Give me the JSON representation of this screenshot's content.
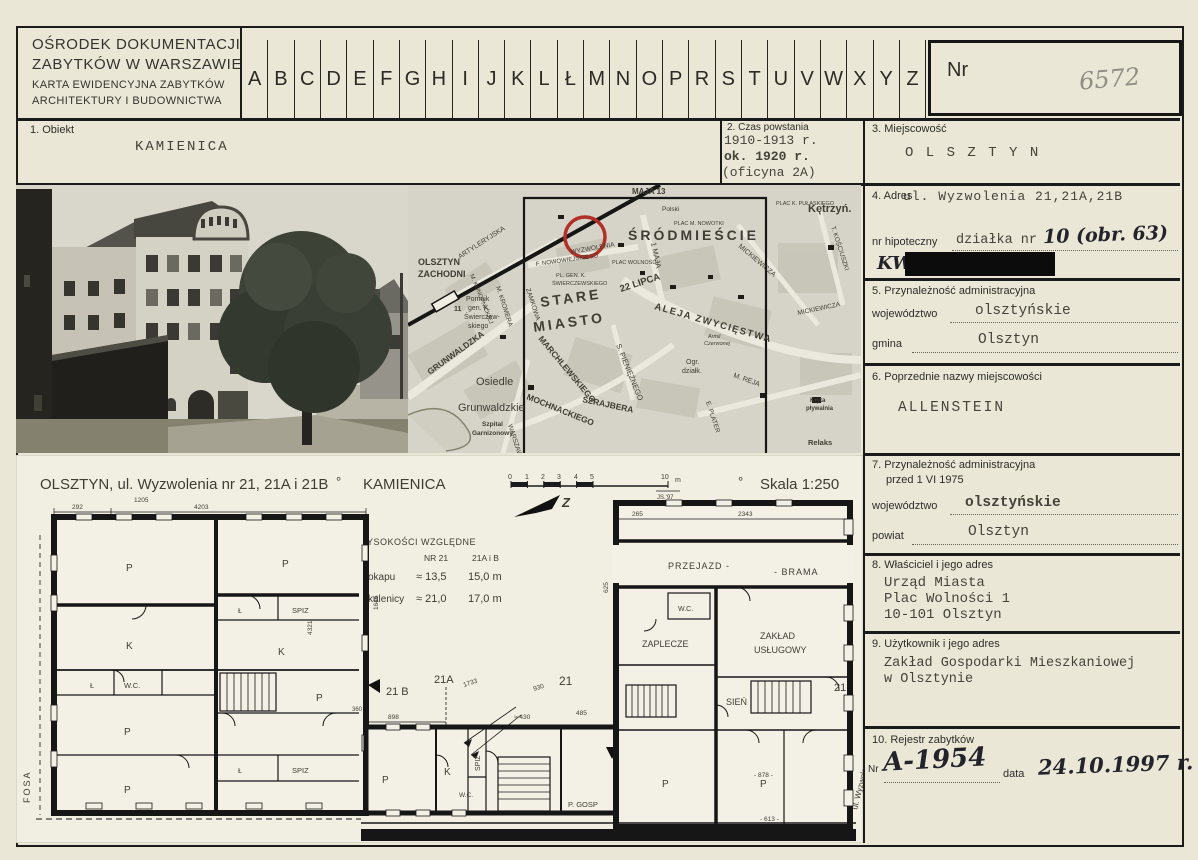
{
  "header": {
    "org_line1": "OŚRODEK DOKUMENTACJI",
    "org_line2": "ZABYTKÓW W WARSZAWIE",
    "card_line1": "KARTA EWIDENCYJNA ZABYTKÓW",
    "card_line2": "ARCHITEKTURY I BUDOWNICTWA",
    "alphabet": [
      "A",
      "B",
      "C",
      "D",
      "E",
      "F",
      "G",
      "H",
      "I",
      "J",
      "K",
      "L",
      "Ł",
      "M",
      "N",
      "O",
      "P",
      "R",
      "S",
      "T",
      "U",
      "V",
      "W",
      "X",
      "Y",
      "Z"
    ],
    "nr_label": "Nr",
    "nr_value": "6572"
  },
  "f1": {
    "label": "1. Obiekt",
    "value": "KAMIENICA"
  },
  "f2": {
    "label": "2. Czas powstania",
    "line1": "1910-1913 r.",
    "line2": "ok. 1920 r.",
    "line3": "(oficyna 2A)"
  },
  "f3": {
    "label": "3. Miejscowość",
    "value": "O L S Z T Y N"
  },
  "f4": {
    "label": "4. Adres",
    "address": "ul. Wyzwolenia 21,21A,21B",
    "hip_label": "nr hipoteczny",
    "hip_typed": "działka nr",
    "hip_hand": "10 (obr. 63)",
    "kw": "KW"
  },
  "f5": {
    "label": "5. Przynależność administracyjna",
    "woj_label": "województwo",
    "woj": "olsztyńskie",
    "gmina_label": "gmina",
    "gmina": "Olsztyn"
  },
  "f6": {
    "label": "6. Poprzednie nazwy miejscowości",
    "value": "ALLENSTEIN"
  },
  "f7": {
    "label": "7. Przynależność administracyjna",
    "label2": "przed 1 VI 1975",
    "woj_label": "województwo",
    "woj": "olsztyńskie",
    "powiat_label": "powiat",
    "powiat": "Olsztyn"
  },
  "f8": {
    "label": "8. Właściciel i jego adres",
    "line1": "Urząd Miasta",
    "line2": "Plac Wolności 1",
    "line3": "10-101 Olsztyn"
  },
  "f9": {
    "label": "9. Użytkownik i jego adres",
    "line1": "Zakład Gospodarki Mieszkaniowej",
    "line2": "w Olsztynie"
  },
  "f10": {
    "label": "10. Rejestr zabytków",
    "nr_label": "Nr",
    "nr_value": "A-1954",
    "data_label": "data",
    "data_value": "24.10.1997 r."
  },
  "map": {
    "srodmiescie": "ŚRÓDMIEŚCIE",
    "stare": "STARE",
    "miasto": "MIASTO",
    "maja13": "MAJA 13",
    "polski": "Polski",
    "plac_nowotki": "PLAC M. NOWOTKI",
    "ketrzyn": "Kętrzyń.",
    "pulaski": "PLAC K. PUŁASKIEGO",
    "olsztyn_z1": "OLSZTYN",
    "olsztyn_z2": "ZACHODNI",
    "artyleryjska": "ARTYLERYJSKA",
    "wyzwolenia": "WYZWOLENIA",
    "plac_wolnosci": "PLAC WOLNOŚCI",
    "maja1": "1 MAJA",
    "lipca22": "22 LIPCA",
    "aleja": "ALEJA ZWYCIĘSTWA",
    "mickiewicza": "MICKIEWICZA",
    "kosciuszki": "T. KOŚCIUSZKI",
    "zamkowa": "ZAMKOWA",
    "kromera": "M. KROMERA",
    "konopnickiej": "M. KONOPNICKIEJ",
    "pomnik_nr": "11",
    "pomnik1": "Pomnik",
    "pomnik2": "gen. K.",
    "pomnik3": "Świerczew-",
    "pomnik4": "skiego",
    "pl_gen1": "PL. GEN. K.",
    "pl_gen2": "ŚWIERCZEWSKIEGO",
    "nowowiejskiego": "F. NOWOWIEJSKIEGO",
    "grunwaldzka": "GRUNWALDZKA",
    "osiedle": "Osiedle",
    "grunwaldzkie": "Grunwaldzkie",
    "szpital1": "Szpital",
    "szpital2": "Garnizonowy",
    "marchlewskiego": "MARCHLEWSKIEGO",
    "mochnackiego": "MOCHNACKIEGO",
    "szrajbera": "SZRAJBERA",
    "pienieznego": "S. PIENIĘŻNEGO",
    "warszawska": "WARSZAWSKA",
    "armii1": "Armii",
    "armii2": "Czerwonej",
    "ogr1": "Ogr.",
    "ogr2": "działk.",
    "plater": "E. PLATER",
    "reja": "M. REJA",
    "kryta1": "Kryta",
    "kryta2": "pływalnia",
    "relaks": "Relaks"
  },
  "plan": {
    "title": "OLSZTYN, ul. Wyzwolenia nr 21, 21A i 21B",
    "sep1": "°",
    "subtitle": "KAMIENICA",
    "sep2": "°",
    "scale": "Skala 1:250",
    "scale_ticks": [
      "0",
      "1",
      "2",
      "3",
      "4",
      "5"
    ],
    "scale_end": "10",
    "scale_unit": "m",
    "sig": "JS.'97",
    "north": "Z",
    "h_title": "WYSOKOŚCI WZGLĘDNE",
    "h_c1": "NR 21",
    "h_c2": "21A i B",
    "h_r1": "H okapu",
    "h_r1a": "≈ 13,5",
    "h_r1b": "15,0 m",
    "h_r2": "H kalenicy",
    "h_r2a": "≈ 21,0",
    "h_r2b": "17,0 m",
    "p": "P",
    "k": "K",
    "l": "Ł",
    "spiz": "SPIZ",
    "spiz2": "SPIŻ",
    "wc": "W.C.",
    "przejazd": "PRZEJAZD -",
    "brama": "- BRAMA",
    "zaplecze": "ZAPLECZE",
    "zaklad1": "ZAKŁAD",
    "zaklad2": "USŁUGOWY",
    "sien": "SIEŃ",
    "pgosp": "P. GOSP",
    "e21b": "21 B",
    "e21a": "21A",
    "e21": "21",
    "e21r": "21",
    "fosa": "FOSA",
    "street": "ul. Wyzwolenia",
    "dims": {
      "d292": "292",
      "d4203": "4203",
      "d1205": "1205",
      "d2343": "2343",
      "d265": "265",
      "d625": "625",
      "d4321": "4321",
      "d1645": "1645",
      "d898": "898",
      "d430": "≈ 430",
      "d1733": "1733",
      "d930": "930",
      "d485": "485",
      "d878": "- 878 -",
      "d613": "- 613 -",
      "d360": "360"
    }
  }
}
